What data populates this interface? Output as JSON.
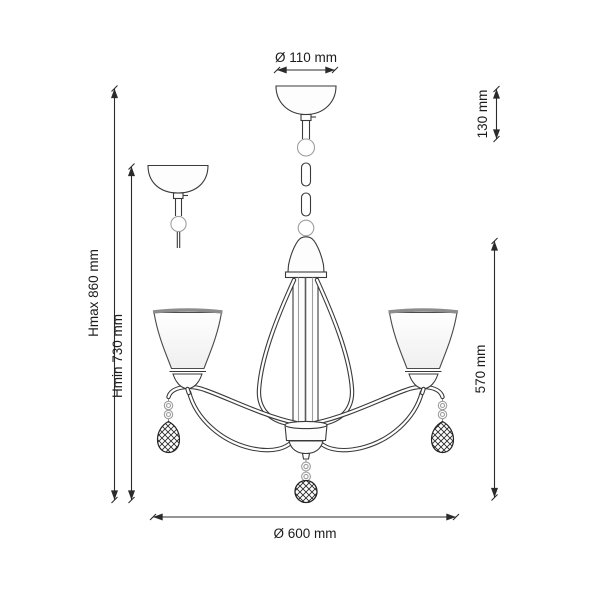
{
  "diagram": {
    "line_color": "#3a3a3a",
    "dimension_color": "#2b2b2b",
    "gray_accent": "#9e9e9e",
    "labels": {
      "top_diameter": "Ø 110 mm",
      "suspension_height": "130 mm",
      "max_height": "Hmax 860 mm",
      "min_height": "Hmin 730 mm",
      "body_height": "570 mm",
      "body_diameter": "Ø 600 mm"
    }
  }
}
